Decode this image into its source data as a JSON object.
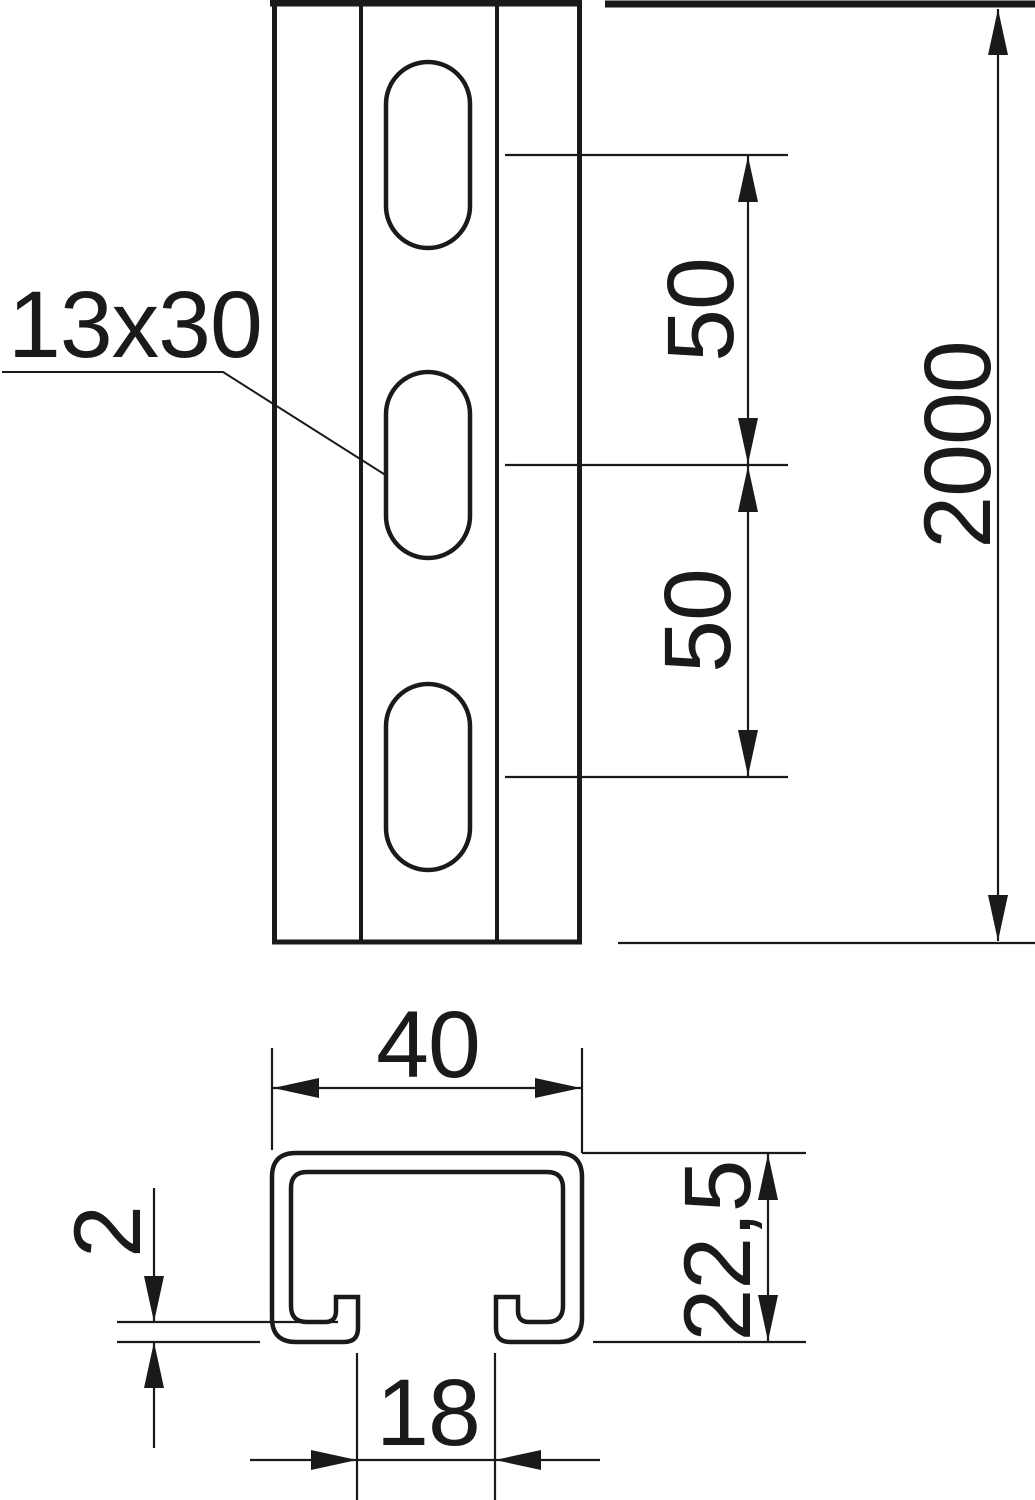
{
  "drawing": {
    "title": "profile-rail-technical-drawing",
    "colors": {
      "ink": "#1a1a1a",
      "paper": "#ffffff"
    },
    "front_view": {
      "slot_size_label": "13x30",
      "slot_pitch_upper": "50",
      "slot_pitch_lower": "50",
      "rail_length": "2000"
    },
    "section_view": {
      "profile_width": "40",
      "material_thickness": "2",
      "profile_height": "22,5",
      "slot_opening": "18"
    }
  }
}
